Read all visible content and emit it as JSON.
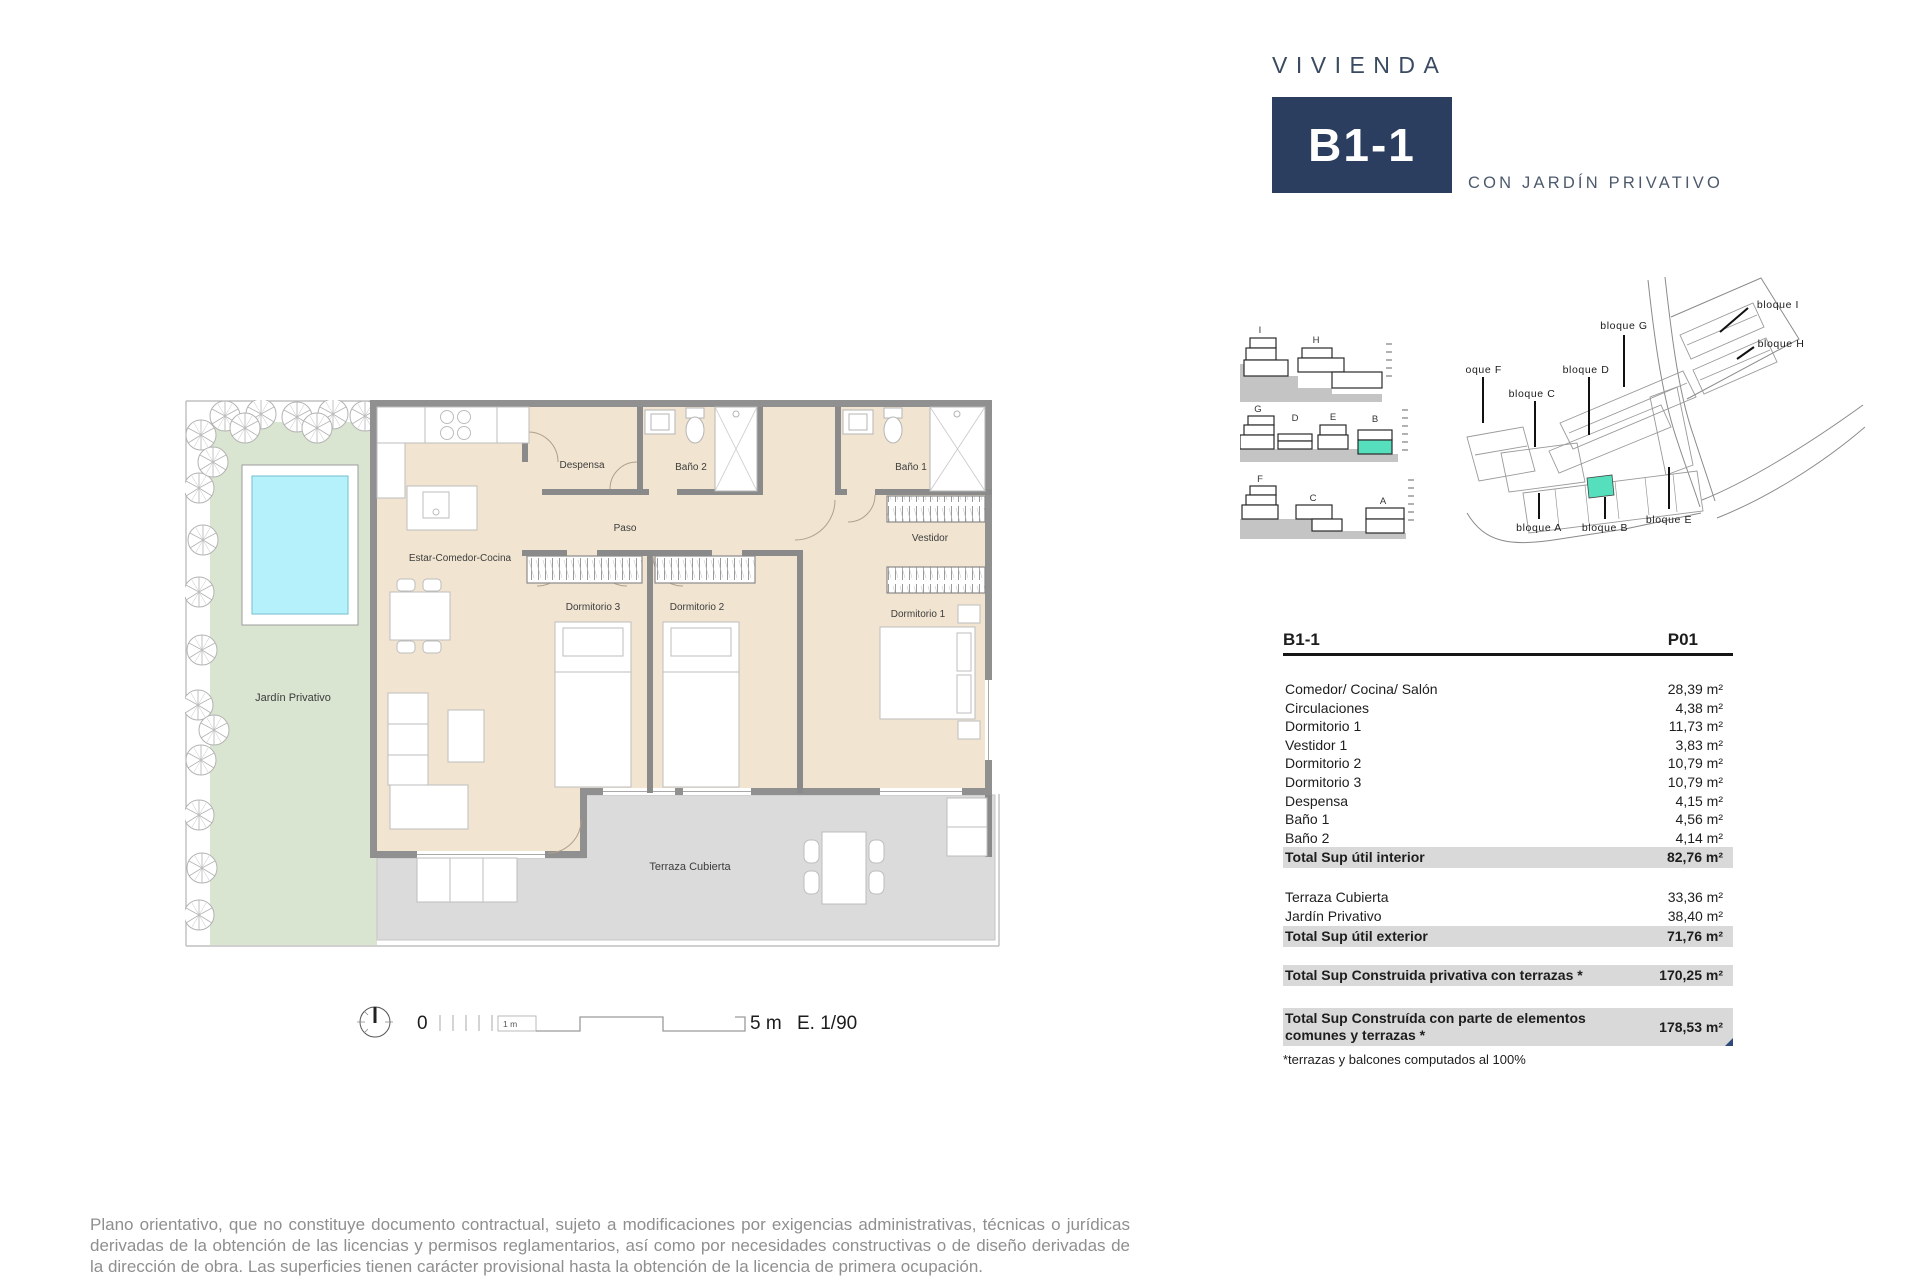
{
  "header": {
    "title": "VIVIENDA",
    "unit": "B1-1",
    "subtitle": "CON JARDÍN PRIVATIVO"
  },
  "plan": {
    "rooms": [
      {
        "name": "Despensa"
      },
      {
        "name": "Baño 2"
      },
      {
        "name": "Baño 1"
      },
      {
        "name": "Paso"
      },
      {
        "name": "Estar-Comedor-Cocina"
      },
      {
        "name": "Vestidor"
      },
      {
        "name": "Dormitorio 3"
      },
      {
        "name": "Dormitorio 2"
      },
      {
        "name": "Dormitorio 1"
      },
      {
        "name": "Jardín Privativo"
      },
      {
        "name": "Terraza Cubierta"
      }
    ]
  },
  "scalebar": {
    "zero": "0",
    "one_m": "1 m",
    "five_m": "5 m",
    "scale": "E. 1/90"
  },
  "elevations": {
    "row1": [
      "I",
      "H"
    ],
    "row2": [
      "G",
      "D",
      "E",
      "B"
    ],
    "row3": [
      "F",
      "C",
      "A"
    ]
  },
  "siteplan": {
    "labels": [
      "bloque F",
      "bloque C",
      "bloque D",
      "bloque G",
      "bloque I",
      "bloque H",
      "bloque A",
      "bloque B",
      "bloque E"
    ]
  },
  "table": {
    "header_left": "B1-1",
    "header_right": "P01",
    "rows": [
      {
        "label": "Comedor/ Cocina/ Salón",
        "value": "28,39 m²"
      },
      {
        "label": "Circulaciones",
        "value": "4,38 m²"
      },
      {
        "label": "Dormitorio 1",
        "value": "11,73 m²"
      },
      {
        "label": "Vestidor 1",
        "value": "3,83 m²"
      },
      {
        "label": "Dormitorio 2",
        "value": "10,79 m²"
      },
      {
        "label": "Dormitorio 3",
        "value": "10,79 m²"
      },
      {
        "label": "Despensa",
        "value": "4,15 m²"
      },
      {
        "label": "Baño 1",
        "value": "4,56 m²"
      },
      {
        "label": "Baño 2",
        "value": "4,14 m²"
      },
      {
        "label": "Total Sup útil interior",
        "value": "82,76 m²"
      },
      {
        "label": "Terraza Cubierta",
        "value": "33,36 m²"
      },
      {
        "label": "Jardín Privativo",
        "value": "38,40 m²"
      },
      {
        "label": "Total Sup útil exterior",
        "value": "71,76 m²"
      },
      {
        "label": "Total Sup Construida privativa con terrazas *",
        "value": "170,25 m²"
      },
      {
        "label": "Total Sup Construída con parte de elementos comunes y terrazas *",
        "value": "178,53 m²"
      }
    ],
    "note": "*terrazas y balcones computados al 100%"
  },
  "disclaimer": "Plano orientativo, que no constituye documento contractual, sujeto a modificaciones por exigencias administrativas, técnicas o jurídicas derivadas de la obtención de las licencias y permisos reglamentarios, así como por necesidades constructivas o de diseño derivadas de la dirección de obra. Las superficies tienen carácter provisional hasta la obtención de la licencia de primera ocupación.",
  "colors": {
    "navy": "#2b3e60",
    "teal_highlight": "#55dfbd",
    "floor_beige": "#f1e5d1",
    "wall_gray": "#909090",
    "terrace_gray": "#dbdbdb",
    "garden_green": "#d9e4d1",
    "pool_cyan": "#b5f1fb",
    "table_bar_gray": "#d9d9d9"
  }
}
